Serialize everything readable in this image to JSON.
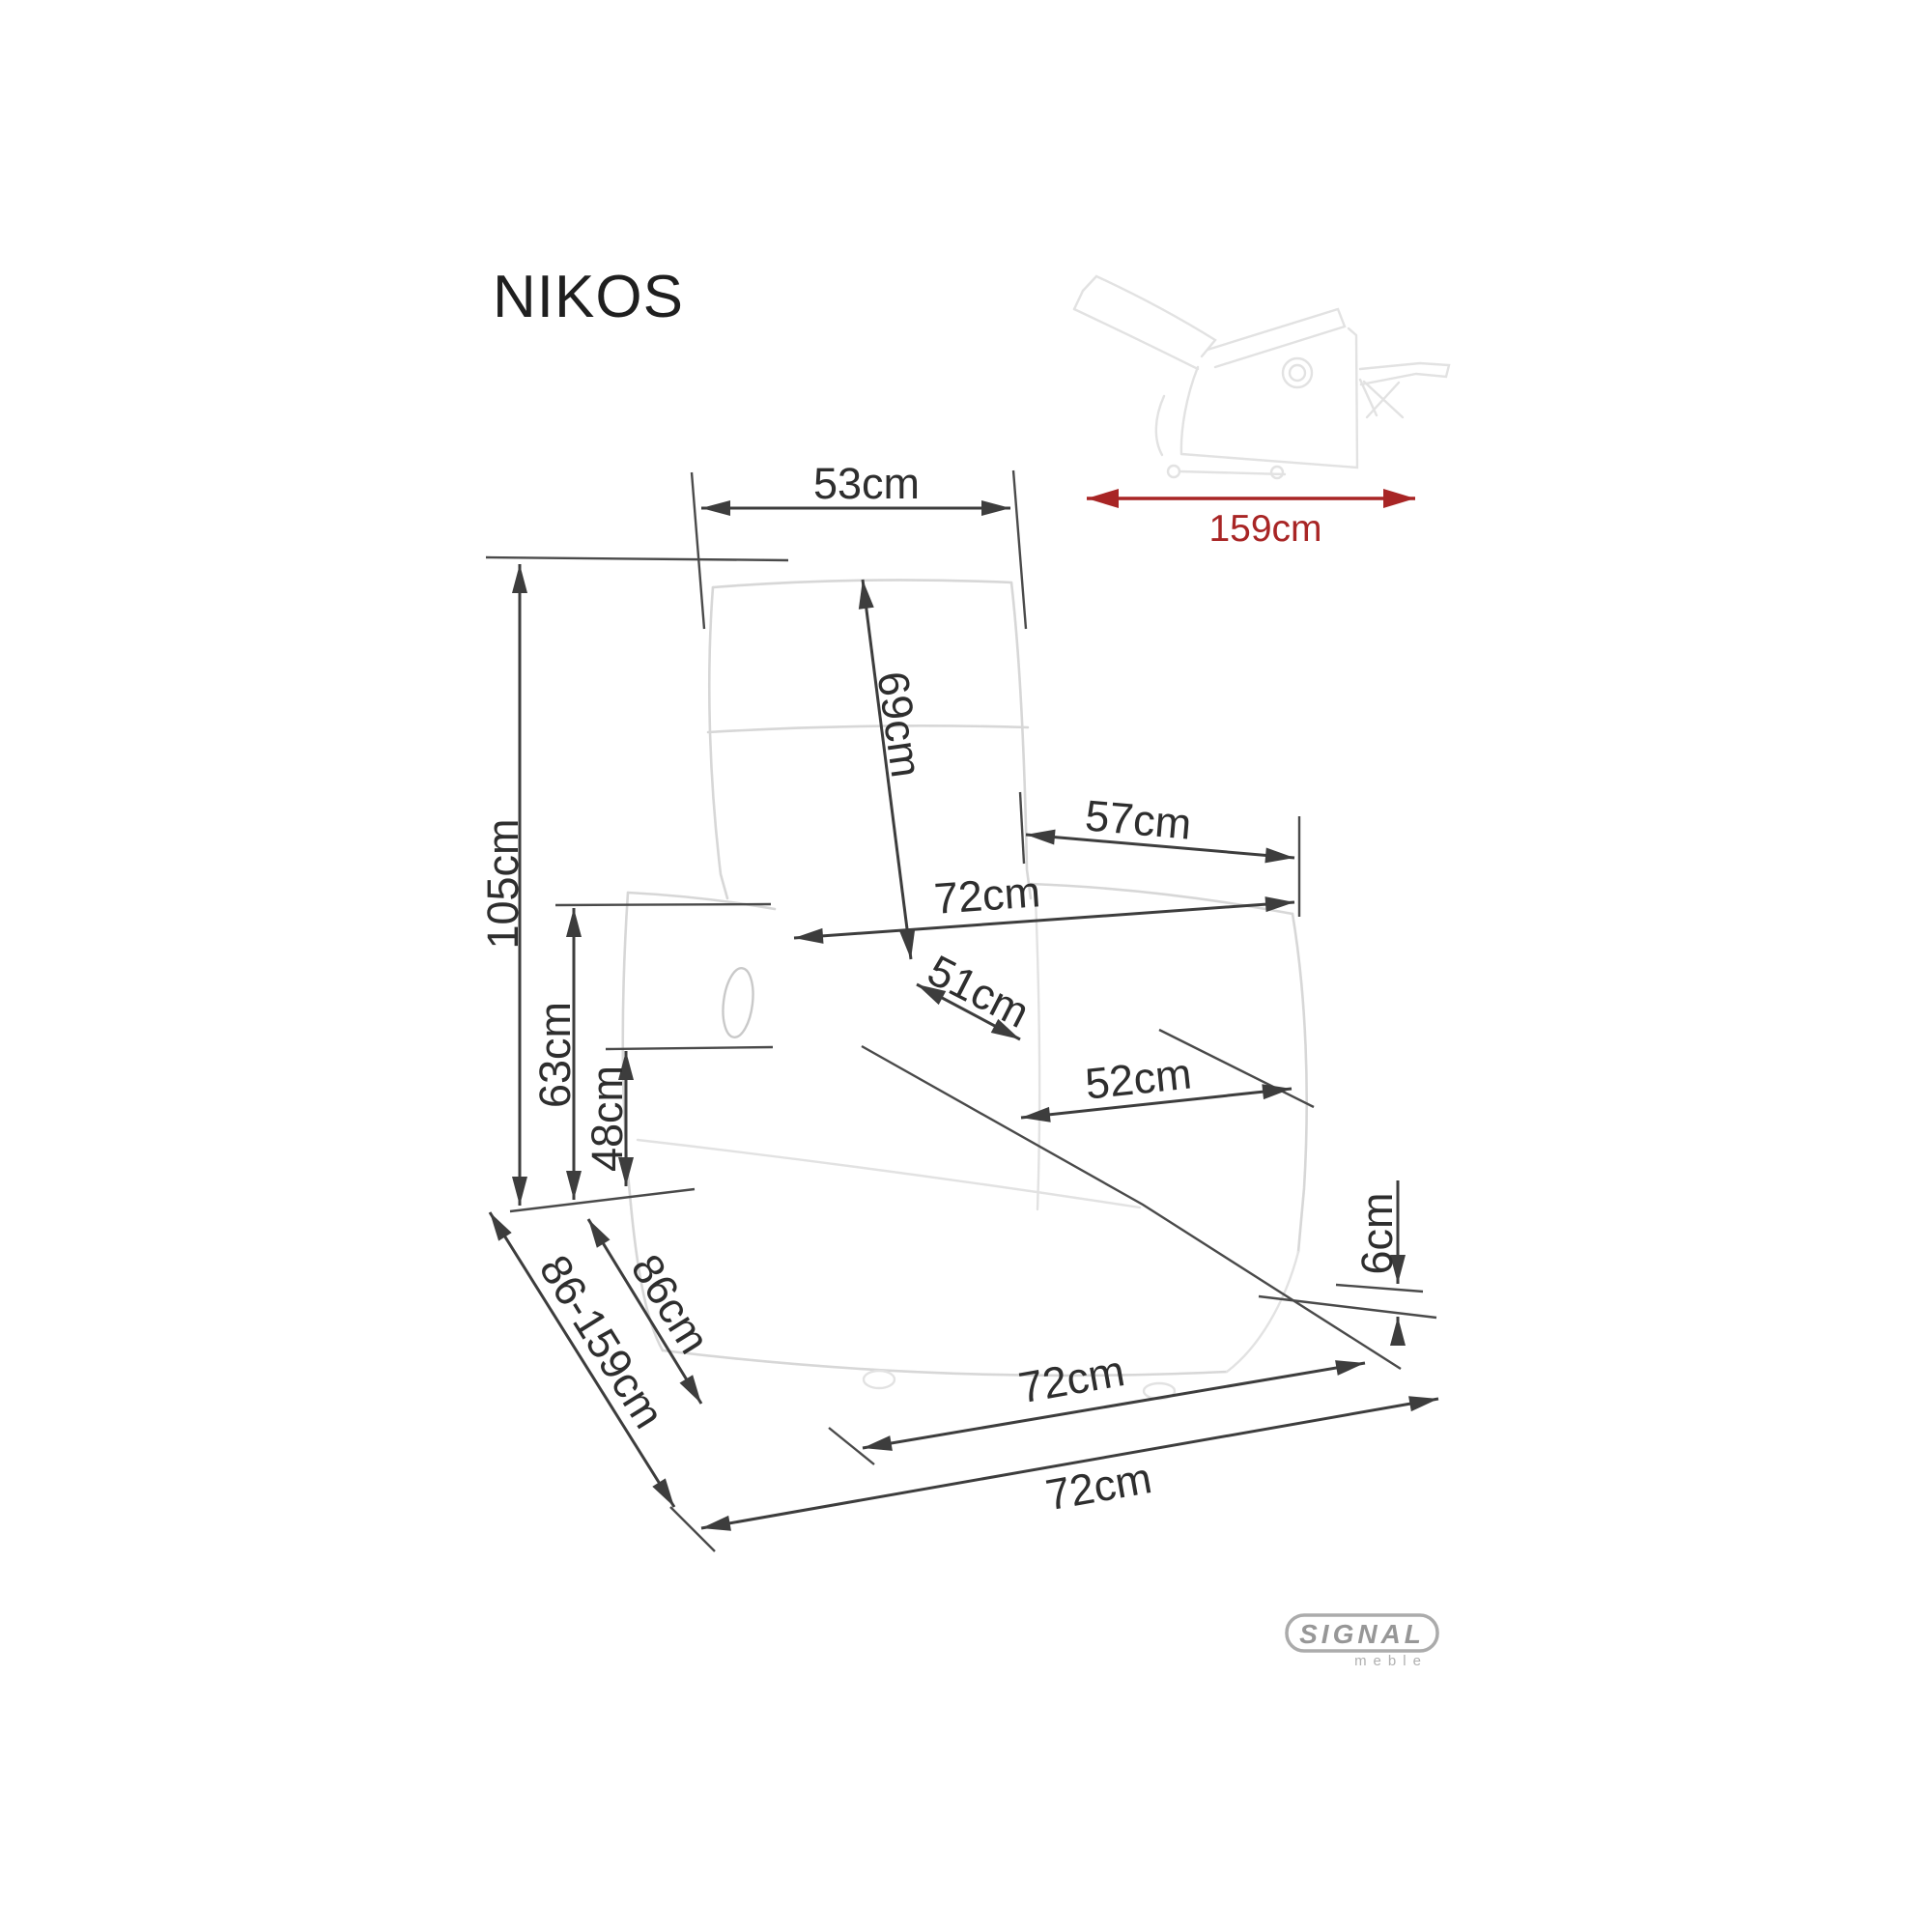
{
  "page": {
    "title_label": "NIKOS"
  },
  "inset": {
    "length": "159cm"
  },
  "dims": {
    "top_width": "53cm",
    "backrest_height": "69cm",
    "total_height": "105cm",
    "armrest_height": "63cm",
    "seat_height": "48cm",
    "inner_back_width": "57cm",
    "overall_width": "72cm",
    "seat_depth": "51cm",
    "seat_width": "52cm",
    "ground_clearance": "6cm",
    "depth_closed": "86cm",
    "depth_range": "86-159cm",
    "base_depth": "72cm",
    "overall_depth": "72cm"
  },
  "brand": {
    "logo": "SIGNAL",
    "sublogo": "meble"
  },
  "colors": {
    "dimension_line": "#3d3d3d",
    "label_text": "#2e2e2e",
    "accent_red": "#a82525",
    "sketch_line": "#d7d7d7",
    "background": "#ffffff"
  }
}
